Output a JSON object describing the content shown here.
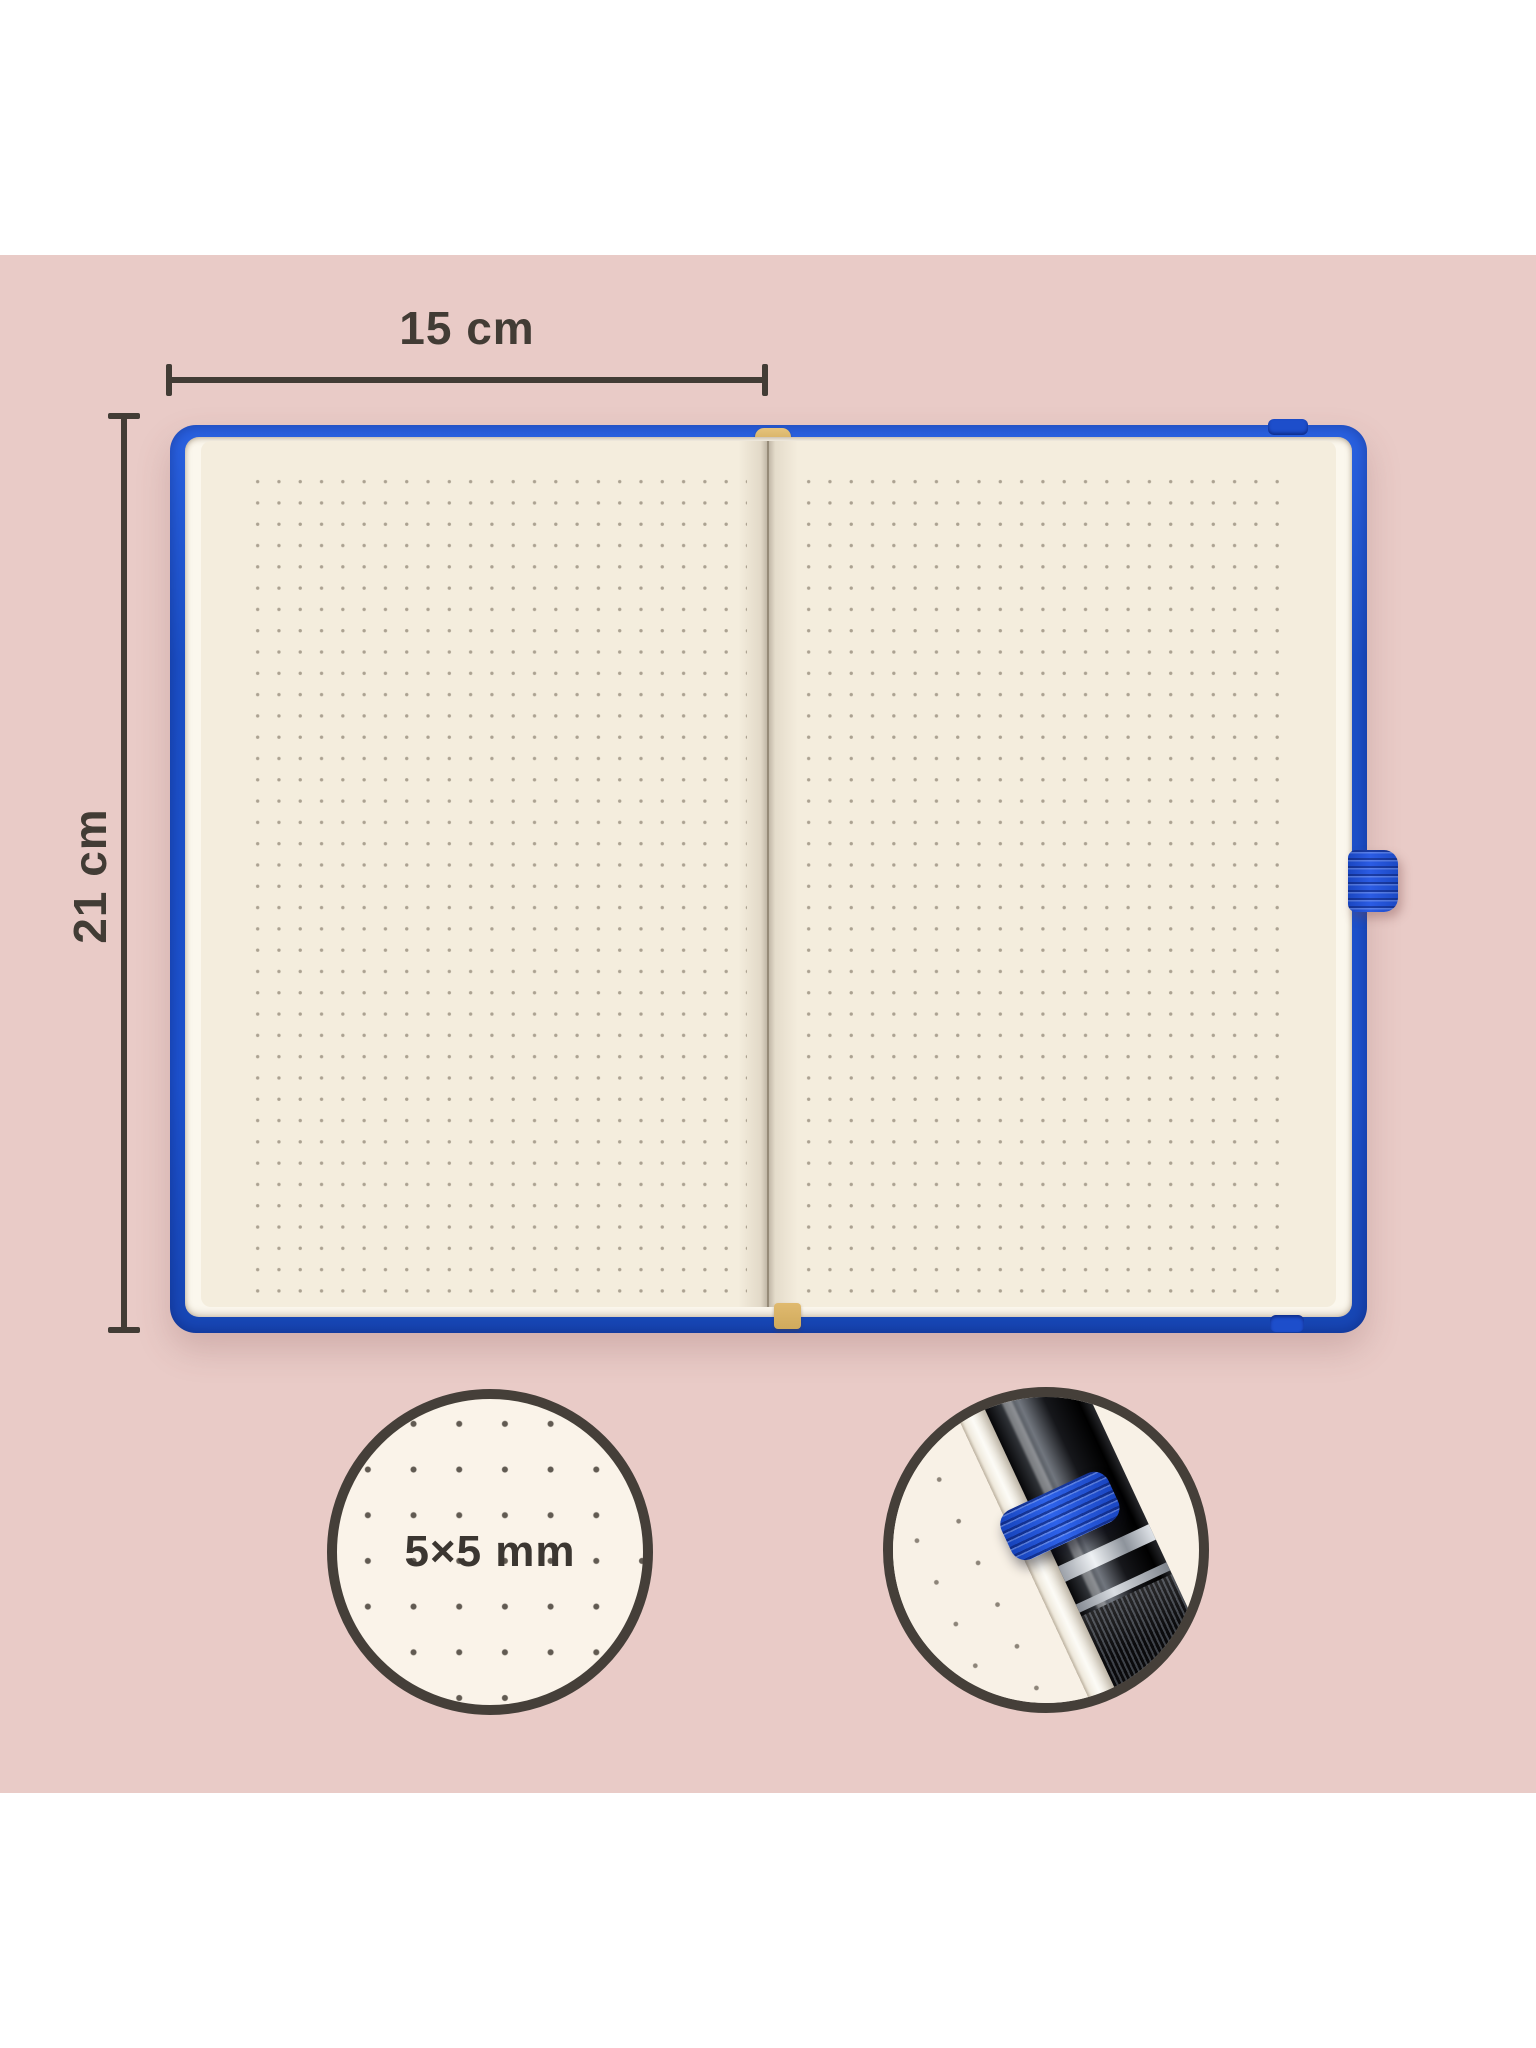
{
  "dimensions": {
    "width_label": "15 cm",
    "height_label": "21 cm"
  },
  "callouts": {
    "dot_grid_label": "5×5 mm"
  },
  "colors": {
    "backdrop_pink": "#e9cbc7",
    "frame_white": "#ffffff",
    "cover_blue": "#1d52cf",
    "paper_cream": "#f4eddd",
    "annotation_dark": "#423c35",
    "bookmark_gold": "#d7b269",
    "pen_loop_blue": "#2b5ce4",
    "callout_border": "#453f39",
    "callout_fill": "#faf3e9"
  }
}
